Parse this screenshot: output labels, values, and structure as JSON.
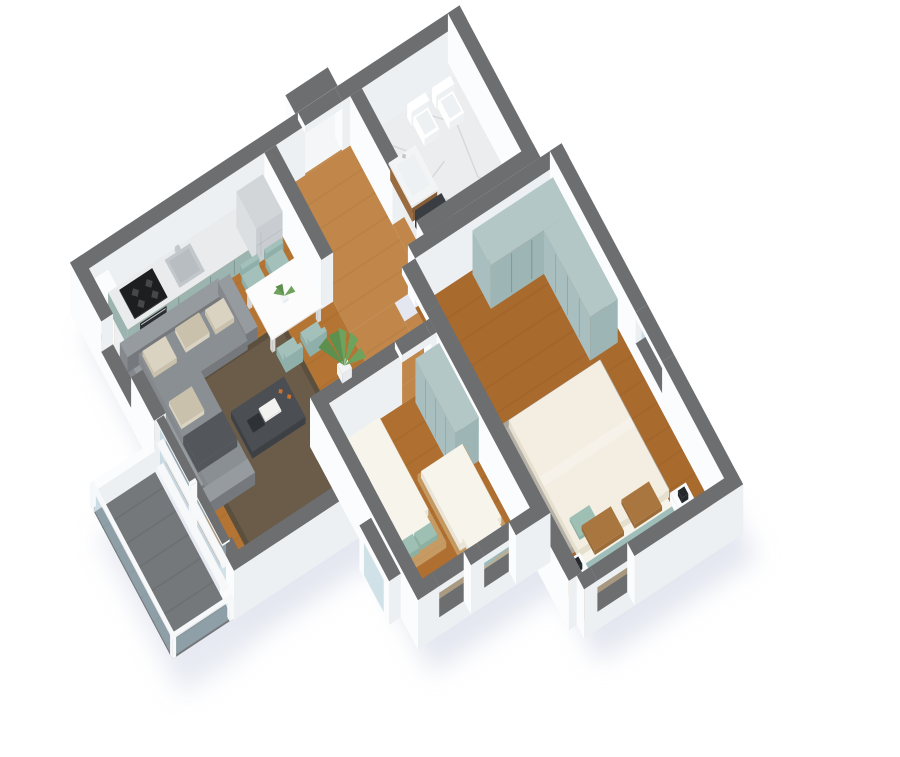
{
  "scene": {
    "background": "#ffffff",
    "view": "isometric-3d-floor-plan"
  },
  "rooms": [
    {
      "name": "living-room"
    },
    {
      "name": "kitchen"
    },
    {
      "name": "dining-area"
    },
    {
      "name": "entrance-hall"
    },
    {
      "name": "bathroom"
    },
    {
      "name": "kids-bedroom"
    },
    {
      "name": "master-bedroom"
    },
    {
      "name": "balcony"
    }
  ],
  "furniture": [
    "corner-sofa",
    "coffee-table",
    "tv-console",
    "tv",
    "living-rug",
    "dining-table",
    "dining-chairs",
    "kitchen-counter",
    "cooktop",
    "oven",
    "sink",
    "fridge",
    "tall-cabinet",
    "potted-plant",
    "single-bed",
    "single-bed",
    "kids-wardrobe",
    "master-wardrobe",
    "double-bed",
    "nightstands",
    "lamps",
    "toilet",
    "bidet",
    "vanity",
    "washing-machine",
    "balcony-glass",
    "sliding-glass-door",
    "windows"
  ],
  "colors": {
    "background": "#ffffff",
    "shadow": "#c3cade",
    "wall_top": "#6c6e70",
    "wall_face": "#fbfcfd",
    "wall_face_shade": "#edf0f3",
    "wood_hall": "#c1874a",
    "wood_living": "#b47534",
    "wood_kids": "#ae6f30",
    "wood_master": "#a96a2d",
    "wood_stripe": "rgba(80,40,8,0.12)",
    "marble": "#ebedef",
    "marble_vein": "#d3d6d9",
    "balcony_floor": "#75787a",
    "balcony_stripe": "rgba(0,0,0,0.12)",
    "glass": "rgba(168,198,212,0.5)",
    "glass_rail": "#f6f8f9",
    "rug_living": "#6a5c48",
    "rug_living_border": "#5b4f3d",
    "rug_master": "#b6b1a8",
    "rug_master_border": "#aaa59b",
    "sofa_top": "#8a8f93",
    "sofa_back": "#969b9f",
    "sofa_side": "#75797d",
    "sofa_west": "#85898d",
    "pillow_a": "#dad3c2",
    "pillow_b": "#c9c1ac",
    "throw_dark": "#53575b",
    "table_top": "#fcfcfc",
    "table_side": "#e8e8e8",
    "table_leg": "#d8d8d8",
    "chair_teal": "#a3c0bb",
    "chair_teal_dark": "#8fb0aa",
    "counter_top": "#e9ebed",
    "cabinet_front": "#9cb4af",
    "cabinet_line": "rgba(55,80,75,0.28)",
    "cooktop": "#1c1e20",
    "burner": "#45484b",
    "oven": "#2b2e31",
    "steel": "#c2c7cb",
    "sink": "#b7bdc1",
    "fridge_front": "#c9cdd1",
    "fridge_side": "#dcdfe2",
    "fridge_top": "#d3d6d9",
    "wardrobe_top": "#b3c7c7",
    "wardrobe_front": "#9db5b5",
    "wardrobe_side": "#a9bfbf",
    "wardrobe_line": "rgba(60,85,85,0.3)",
    "bed_platform": "#c59a63",
    "bed_white_top": "#f7f4ec",
    "bed_white_side": "#e9e5d9",
    "pillow_teal": "#9dbfb4",
    "pillow_teal_dark": "#8bb1a5",
    "duvet_cream": "#f3eee1",
    "duvet_cream_side": "#e5dfce",
    "headboard_teal": "#9fbdb9",
    "pillow_brown": "#a8763e",
    "pillow_brown2": "#9c6d38",
    "nightstand": "#fafbfc",
    "nightstand_side": "#e9ecef",
    "lamp_dark": "#26292c",
    "plant_green": "#5d8f4e",
    "plant_green2": "#6fa35d",
    "pot_white": "#f2f4f5",
    "wood_vanity": "#9a6b3f",
    "wood_vanity_side": "#855c35",
    "washer": "#3a3d41",
    "washer_face": "#2e3134",
    "tv_dark": "#141619",
    "console": "#55585c",
    "console_side": "#44474b",
    "coffee_top": "#4b4f53",
    "coffee_side": "#3d4145",
    "book_light": "#f2f2f0",
    "book_dark": "#2e3135",
    "candle_orange": "#d2722a",
    "door_white": "#f4f6f8",
    "toilet_white": "#ffffff",
    "toilet_side": "#eef1f3"
  }
}
